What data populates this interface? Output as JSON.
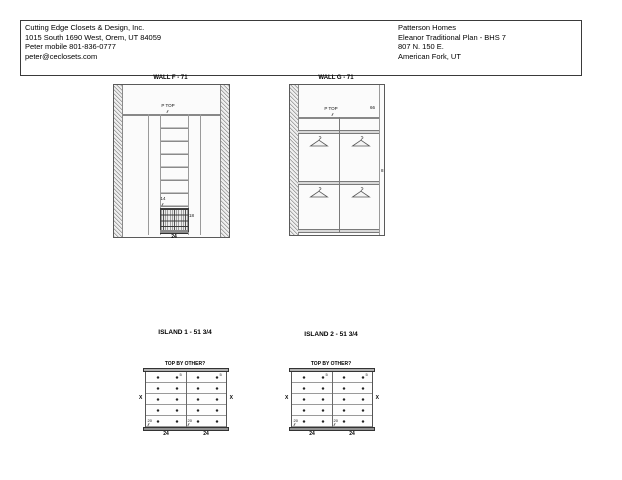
{
  "colors": {
    "line": "#8a8a8a",
    "dark": "#333333",
    "band_fill": "#d8d8d8",
    "background": "#ffffff"
  },
  "header": {
    "company": {
      "name": "Cutting Edge Closets & Design, Inc.",
      "address": "1015 South 1690 West, Orem, UT  84059",
      "phone": "Peter mobile 801-836-0777",
      "email": "peter@ceclosets.com"
    },
    "client": {
      "name": "Patterson Homes",
      "plan": "Eleanor Traditional Plan - BHS 7",
      "address": "807 N. 150 E.",
      "city": "American Fork, UT"
    }
  },
  "wall_f": {
    "title": "WALL F - 71",
    "ptop": "P TOP",
    "tower_label": "14",
    "basket_label": "18",
    "width_dim": "24"
  },
  "wall_g": {
    "title": "WALL G - 71",
    "ptop": "P TOP",
    "top_right_dim": "66",
    "right_dim": "8"
  },
  "islands": {
    "one": {
      "title": "ISLAND 1 - 51 3/4"
    },
    "two": {
      "title": "ISLAND 2 - 51 3/4"
    },
    "top_note": "TOP BY OTHER?",
    "side_label": "X",
    "top_drawer_label": "5",
    "bottom_drawer_label": "20",
    "column_dim": "24"
  }
}
